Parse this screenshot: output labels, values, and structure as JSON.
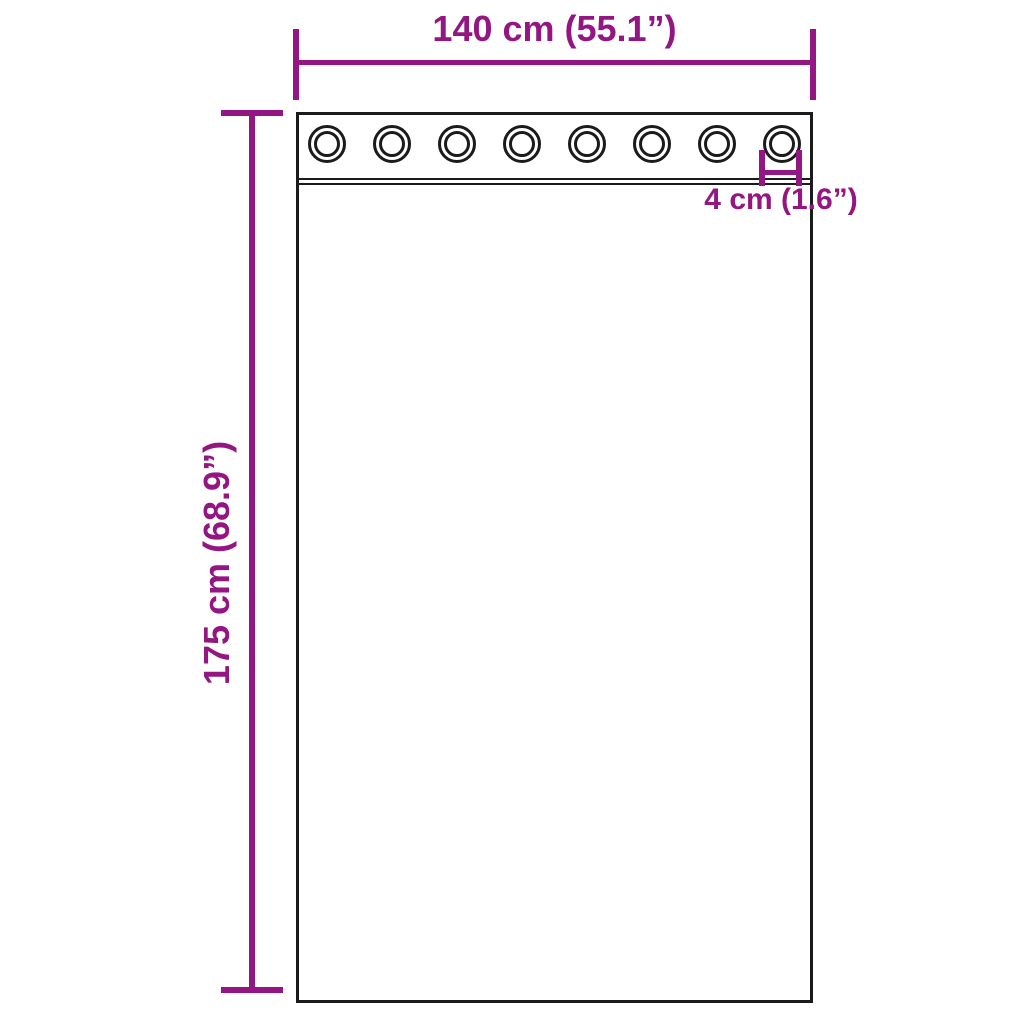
{
  "colors": {
    "accent": "#941683",
    "outline": "#1b1b1b",
    "bg": "#ffffff"
  },
  "diagram": {
    "width_label": "140 cm (55.1”)",
    "height_label": "175 cm (68.9”)",
    "grommet_label": "4 cm (1.6”)",
    "grommet_count": 8
  }
}
